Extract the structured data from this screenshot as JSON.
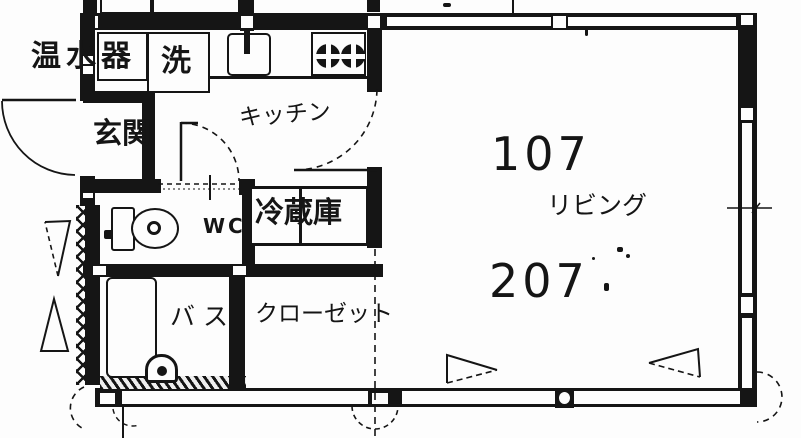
{
  "document": {
    "kind": "apartment-floor-plan",
    "style": "scanned-blueprint"
  },
  "colors": {
    "ink": "#151515",
    "paper": "#fdfdfd"
  },
  "rooms": {
    "entrance": "玄関",
    "kitchen": "キッチン",
    "toilet": "WC",
    "bath": "バス",
    "closet": "クローゼット",
    "living": "リビング"
  },
  "fixtures": {
    "water_heater": "温水器",
    "washer": "洗",
    "fridge": "冷蔵庫"
  },
  "unit_numbers": {
    "top": "107",
    "bottom": "207"
  }
}
